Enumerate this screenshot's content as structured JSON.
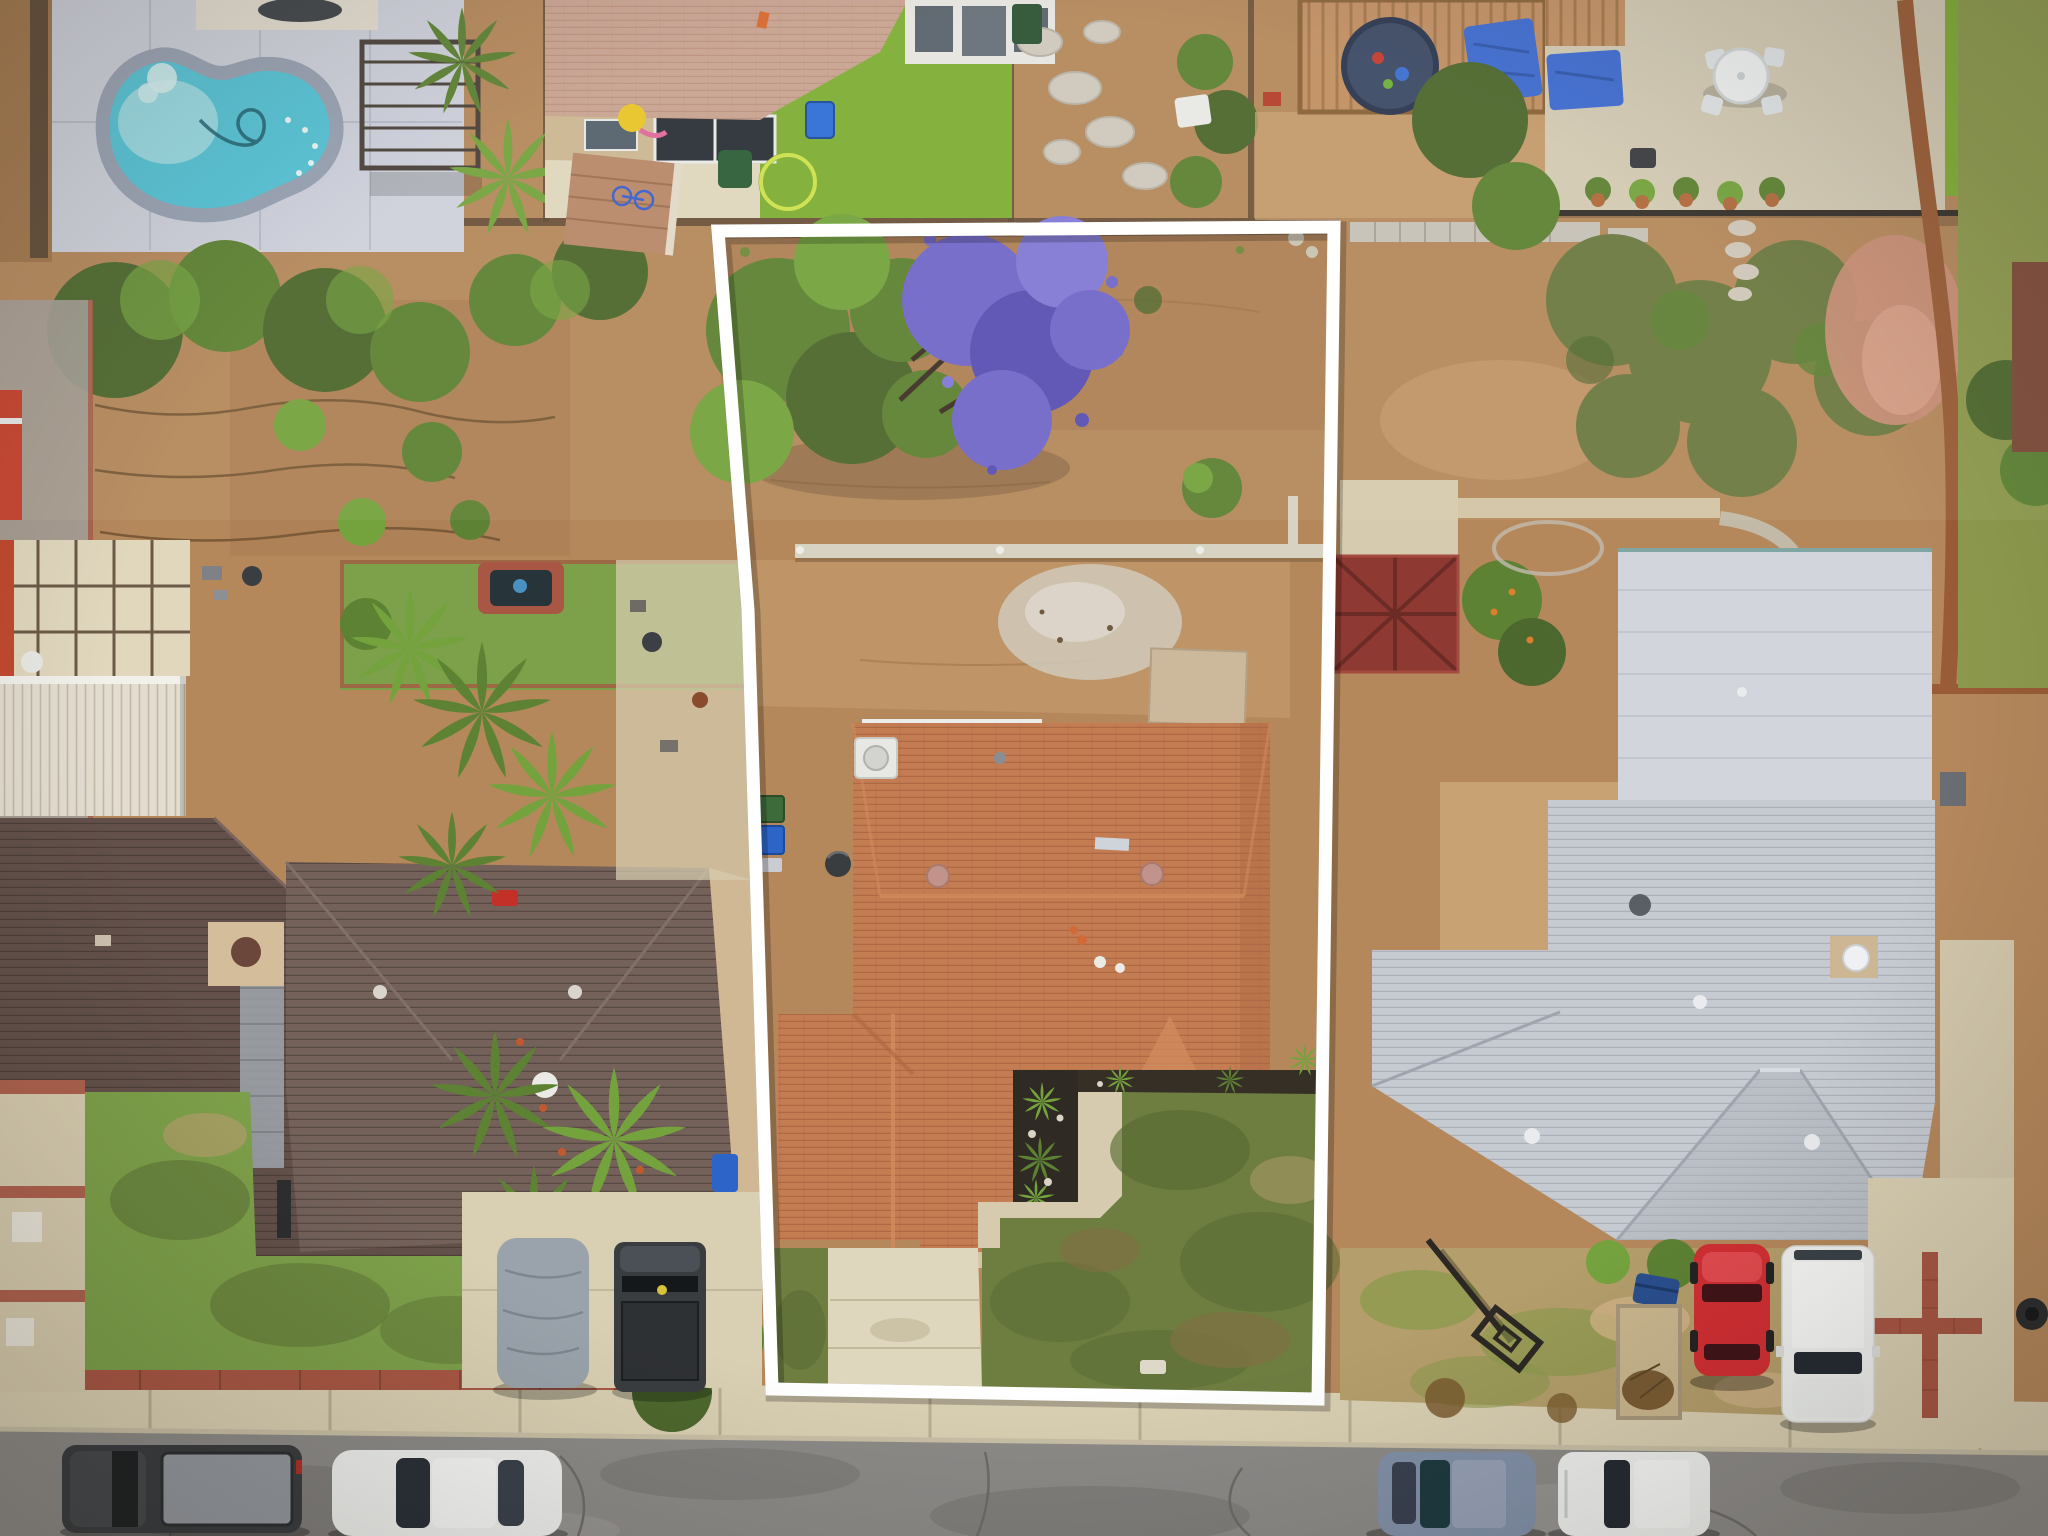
{
  "image": {
    "kind": "aerial-drone-photo",
    "subject": "suburban residential lot outlined with a white property-boundary overlay",
    "visible_text": "none",
    "boundary_stroke_px": 13
  },
  "colors": {
    "dirt_base": "#b5885c",
    "dirt_dark": "#a1764b",
    "dirt_light": "#c9a273",
    "dirt_pale": "#d6b68c",
    "ash_gray": "#cfc5b6",
    "ash_light": "#dcd4c8",
    "concrete": "#d6cbae",
    "concrete_light": "#e0d7bd",
    "concrete_cool": "#ced1dc",
    "sidewalk": "#d9cfb2",
    "street_asphalt": "#8d8b88",
    "street_dark": "#7b7977",
    "street_light": "#9b9996",
    "curb": "#c9c0a6",
    "boundary_white": "#ffffff",
    "roof_terracotta": "#c47c52",
    "roof_terracotta_light": "#d18b5e",
    "roof_terracotta_dark": "#ad6843",
    "roof_brown_a": "#63504a",
    "roof_brown_b": "#73615a",
    "roof_gray": "#c6cad1",
    "roof_gray_light": "#d2d6dc",
    "roof_gray_dark": "#aeb3bc",
    "roof_pink_tan": "#c9a392",
    "gazebo_red": "#8e3a33",
    "pool_water": "#55c3d6",
    "pool_water_light": "#a5dee5",
    "pool_coping": "#98a1b3",
    "lawn_green": "#7da04a",
    "lawn_bright": "#7fae35",
    "lawn_olive": "#8d9a4d",
    "lawn_mottled": "#6e7d40",
    "lawn_dark": "#586b33",
    "lawn_dry": "#b49e6b",
    "tree_dark": "#4d682e",
    "tree_mid": "#5d8233",
    "tree_light": "#74a33e",
    "tree_olive": "#6d7a42",
    "jacaranda_purple": "#7168c9",
    "jacaranda_purple_dark": "#5a51b4",
    "jacaranda_purple_light": "#8279d6",
    "mulch_dark": "#2f2a23",
    "tarp_blue": "#3f6cd1",
    "bin_blue": "#2d64c8",
    "bin_green": "#3e6b3a",
    "car_red": "#d02f33",
    "car_red_light": "#e04a4e",
    "car_white": "#eff0ee",
    "car_blue_gray": "#8291a8",
    "truck_dark": "#3a3d40",
    "truck_bed_gray": "#94999f",
    "tarp_car_gray": "#9aa3ab",
    "wood_tan": "#c29064",
    "brick_red": "#a85744",
    "wall_cream": "#e3ddd0",
    "wall_tan": "#d3bd9a",
    "fence_brown": "#5f4a36",
    "fence_rust": "#9a5c36",
    "pink_dirt": "#cb8f78",
    "window_dark": "#2b3138",
    "white_trim": "#ececea"
  },
  "scene": {
    "overlay": "white quadrilateral property boundary around center lot",
    "subject_lot": [
      "dirt backyard",
      "jacaranda tree with purple blooms",
      "low retaining wall",
      "ash patch",
      "concrete pad",
      "terracotta shingle roof house",
      "rooftop AC unit",
      "black mulch planting bed with plants",
      "concrete walkway",
      "concrete driveway",
      "mottled front lawn",
      "green trash bin",
      "blue trash bin"
    ],
    "left_lot": [
      "kidney-shaped swimming pool",
      "pool deck",
      "metal pergola",
      "paver patio",
      "white carport roof",
      "two dark brown shingle roofs",
      "chimney",
      "satellite dishes",
      "palm trees",
      "garden with pond",
      "front lawn",
      "tarp-covered car",
      "black pickup truck",
      "brick planter edge"
    ],
    "top_lots": [
      "tan tile-roof house with patio",
      "bright lawn with yellow hoop",
      "storage shed",
      "flagstone yard",
      "wood pergola",
      "trampoline",
      "blue tarps",
      "white patio table with chairs",
      "tree on bright lawn"
    ],
    "right_lot": [
      "gray shingle roof house",
      "flat garage roof",
      "dark red gazebo roof",
      "olive scrub trees",
      "pink dirt patch",
      "rust wood fence",
      "dry front lawn",
      "fallen basketball hoop",
      "wood planter box",
      "blue trash bin",
      "red car in driveway",
      "white pickup in driveway",
      "driveway with red brick cross inlay"
    ],
    "street": [
      "concrete sidewalk",
      "asphalt road with cracks",
      "dark gray pickup",
      "white sedan",
      "blue-gray sedan",
      "white SUV"
    ]
  }
}
